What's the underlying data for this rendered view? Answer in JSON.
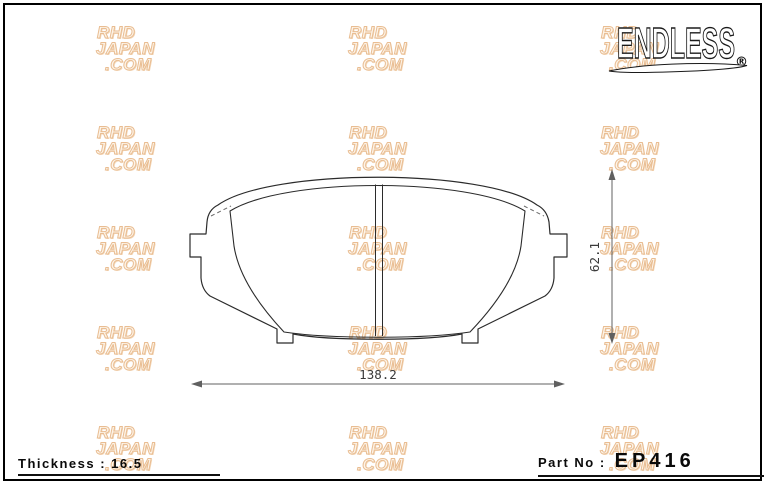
{
  "logo": {
    "brand": "ENDLESS",
    "registered_mark": "®"
  },
  "watermark": {
    "lines": [
      "RHD",
      "JAPAN",
      ".COM"
    ]
  },
  "drawing": {
    "width_dimension_label": "138.2",
    "height_dimension_label": "62.1"
  },
  "footer": {
    "thickness_text": "Thickness : 16.5",
    "part_no_label": "Part No :",
    "part_number": "EP416"
  },
  "colors": {
    "line": "#2b2b2b",
    "dimension_line": "#606060",
    "watermark_fill": "#fdf4e8",
    "watermark_outline": "#e9bd92"
  }
}
